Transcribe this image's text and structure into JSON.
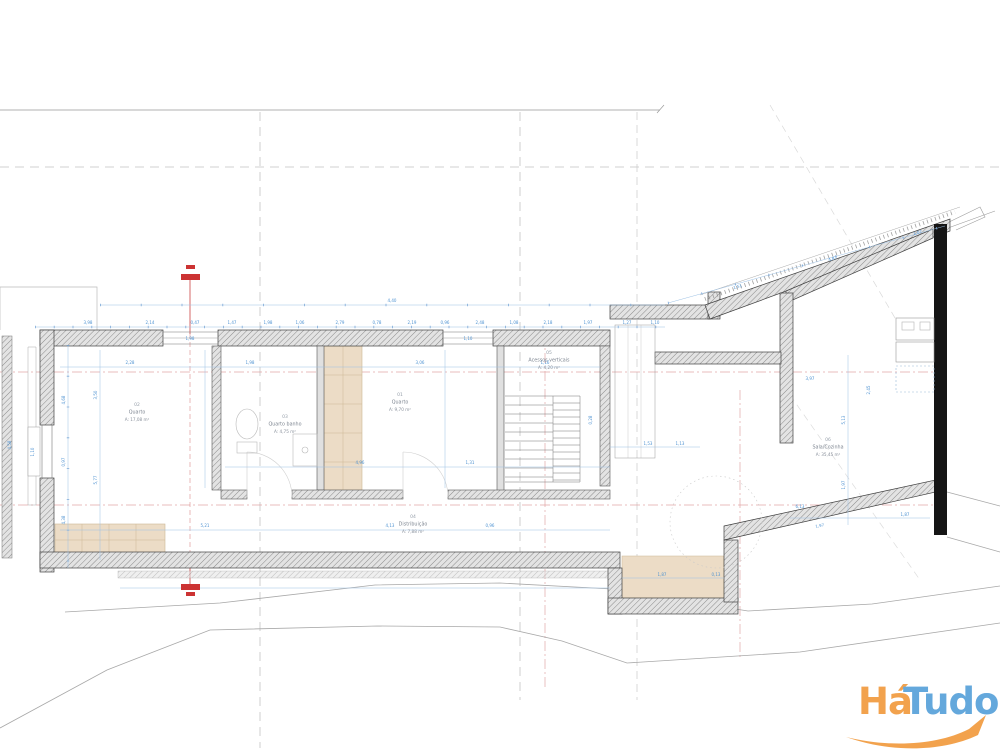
{
  "watermark": {
    "brand_part1": "Há",
    "brand_part2": "Tudo",
    "color_part1": "#f2a24d",
    "color_part2": "#64a8dc",
    "swoosh_color": "#f2a24d"
  },
  "drawing": {
    "type": "architectural floor plan",
    "colors": {
      "wall_hatch": "#8a8a8a",
      "wall_edge": "#3f3f3f",
      "solid_wall": "#151515",
      "dimension_blue": "#4f93d2",
      "chain_blue": "#9cc0e4",
      "section_pink": "#e2a6a6",
      "section_red": "#cc3333",
      "terrain_gray": "#a8a8a8",
      "grid_dash_gray": "#c4c4c4",
      "furniture_beige": "#ecdcc6",
      "furniture_beige_edge": "#cdb795"
    },
    "rooms": [
      {
        "number": "02",
        "name": "Quarto",
        "area": "A: 17,08 m²",
        "x": 137,
        "y": 406
      },
      {
        "number": "03",
        "name": "Quarto banho",
        "area": "A: 4,75 m²",
        "x": 285,
        "y": 418
      },
      {
        "number": "01",
        "name": "Quarto",
        "area": "A: 9,70 m²",
        "x": 400,
        "y": 396
      },
      {
        "number": "04",
        "name": "Distribuição",
        "area": "A: 7,88 m²",
        "x": 413,
        "y": 518
      },
      {
        "number": "05",
        "name": "Acessos verticais",
        "area": "A: 4,20 m²",
        "x": 549,
        "y": 354
      },
      {
        "number": "06",
        "name": "Sala/Cozinha",
        "area": "A: 35,45 m²",
        "x": 828,
        "y": 441
      }
    ],
    "dimensions": [
      {
        "t": "3,98",
        "x": 88,
        "y": 324
      },
      {
        "t": "2,14",
        "x": 150,
        "y": 324
      },
      {
        "t": "0,47",
        "x": 195,
        "y": 324
      },
      {
        "t": "1,47",
        "x": 232,
        "y": 324
      },
      {
        "t": "1,98",
        "x": 268,
        "y": 324
      },
      {
        "t": "1,06",
        "x": 300,
        "y": 324
      },
      {
        "t": "2,79",
        "x": 340,
        "y": 324
      },
      {
        "t": "0,78",
        "x": 377,
        "y": 324
      },
      {
        "t": "2,19",
        "x": 412,
        "y": 324
      },
      {
        "t": "0,96",
        "x": 445,
        "y": 324
      },
      {
        "t": "2,48",
        "x": 480,
        "y": 324
      },
      {
        "t": "1,08",
        "x": 514,
        "y": 324
      },
      {
        "t": "2,18",
        "x": 548,
        "y": 324
      },
      {
        "t": "1,97",
        "x": 588,
        "y": 324
      },
      {
        "t": "1,27",
        "x": 627,
        "y": 324
      },
      {
        "t": "1,10",
        "x": 655,
        "y": 324
      },
      {
        "t": "4,40",
        "x": 392,
        "y": 302
      },
      {
        "t": "1,51",
        "x": 738,
        "y": 288,
        "r": -16
      },
      {
        "t": "4,87",
        "x": 833,
        "y": 260,
        "r": -16
      },
      {
        "t": "1,07",
        "x": 918,
        "y": 234,
        "r": -16
      },
      {
        "t": "4,68",
        "x": 65,
        "y": 400,
        "r": -90
      },
      {
        "t": "0,97",
        "x": 65,
        "y": 462,
        "r": -90
      },
      {
        "t": "4,38",
        "x": 65,
        "y": 520,
        "r": -90
      },
      {
        "t": "3,50",
        "x": 97,
        "y": 395,
        "r": -90
      },
      {
        "t": "5,77",
        "x": 97,
        "y": 480,
        "r": -90
      },
      {
        "t": "4,58",
        "x": 11,
        "y": 445,
        "r": -90
      },
      {
        "t": "1,10",
        "x": 34,
        "y": 452,
        "r": -90
      },
      {
        "t": "2,28",
        "x": 130,
        "y": 364
      },
      {
        "t": "1,98",
        "x": 250,
        "y": 364
      },
      {
        "t": "3,06",
        "x": 420,
        "y": 364
      },
      {
        "t": "1,16",
        "x": 545,
        "y": 364
      },
      {
        "t": "4,96",
        "x": 360,
        "y": 464
      },
      {
        "t": "1,31",
        "x": 470,
        "y": 464
      },
      {
        "t": "5,21",
        "x": 205,
        "y": 527
      },
      {
        "t": "4,13",
        "x": 390,
        "y": 527
      },
      {
        "t": "0,96",
        "x": 490,
        "y": 527
      },
      {
        "t": "1,53",
        "x": 648,
        "y": 445
      },
      {
        "t": "1,13",
        "x": 680,
        "y": 445
      },
      {
        "t": "0,28",
        "x": 592,
        "y": 420,
        "r": -90
      },
      {
        "t": "5,13",
        "x": 845,
        "y": 420,
        "r": -90
      },
      {
        "t": "1,97",
        "x": 845,
        "y": 485,
        "r": -90
      },
      {
        "t": "1,87",
        "x": 905,
        "y": 516
      },
      {
        "t": "6,13",
        "x": 800,
        "y": 508
      },
      {
        "t": "1,97",
        "x": 820,
        "y": 527,
        "r": -12
      },
      {
        "t": "1,87",
        "x": 662,
        "y": 576
      },
      {
        "t": "0,13",
        "x": 716,
        "y": 576
      },
      {
        "t": "1,98",
        "x": 190,
        "y": 340
      },
      {
        "t": "1,10",
        "x": 468,
        "y": 340
      },
      {
        "t": "2,45",
        "x": 870,
        "y": 390,
        "r": -90
      },
      {
        "t": "3,97",
        "x": 810,
        "y": 380
      }
    ]
  }
}
